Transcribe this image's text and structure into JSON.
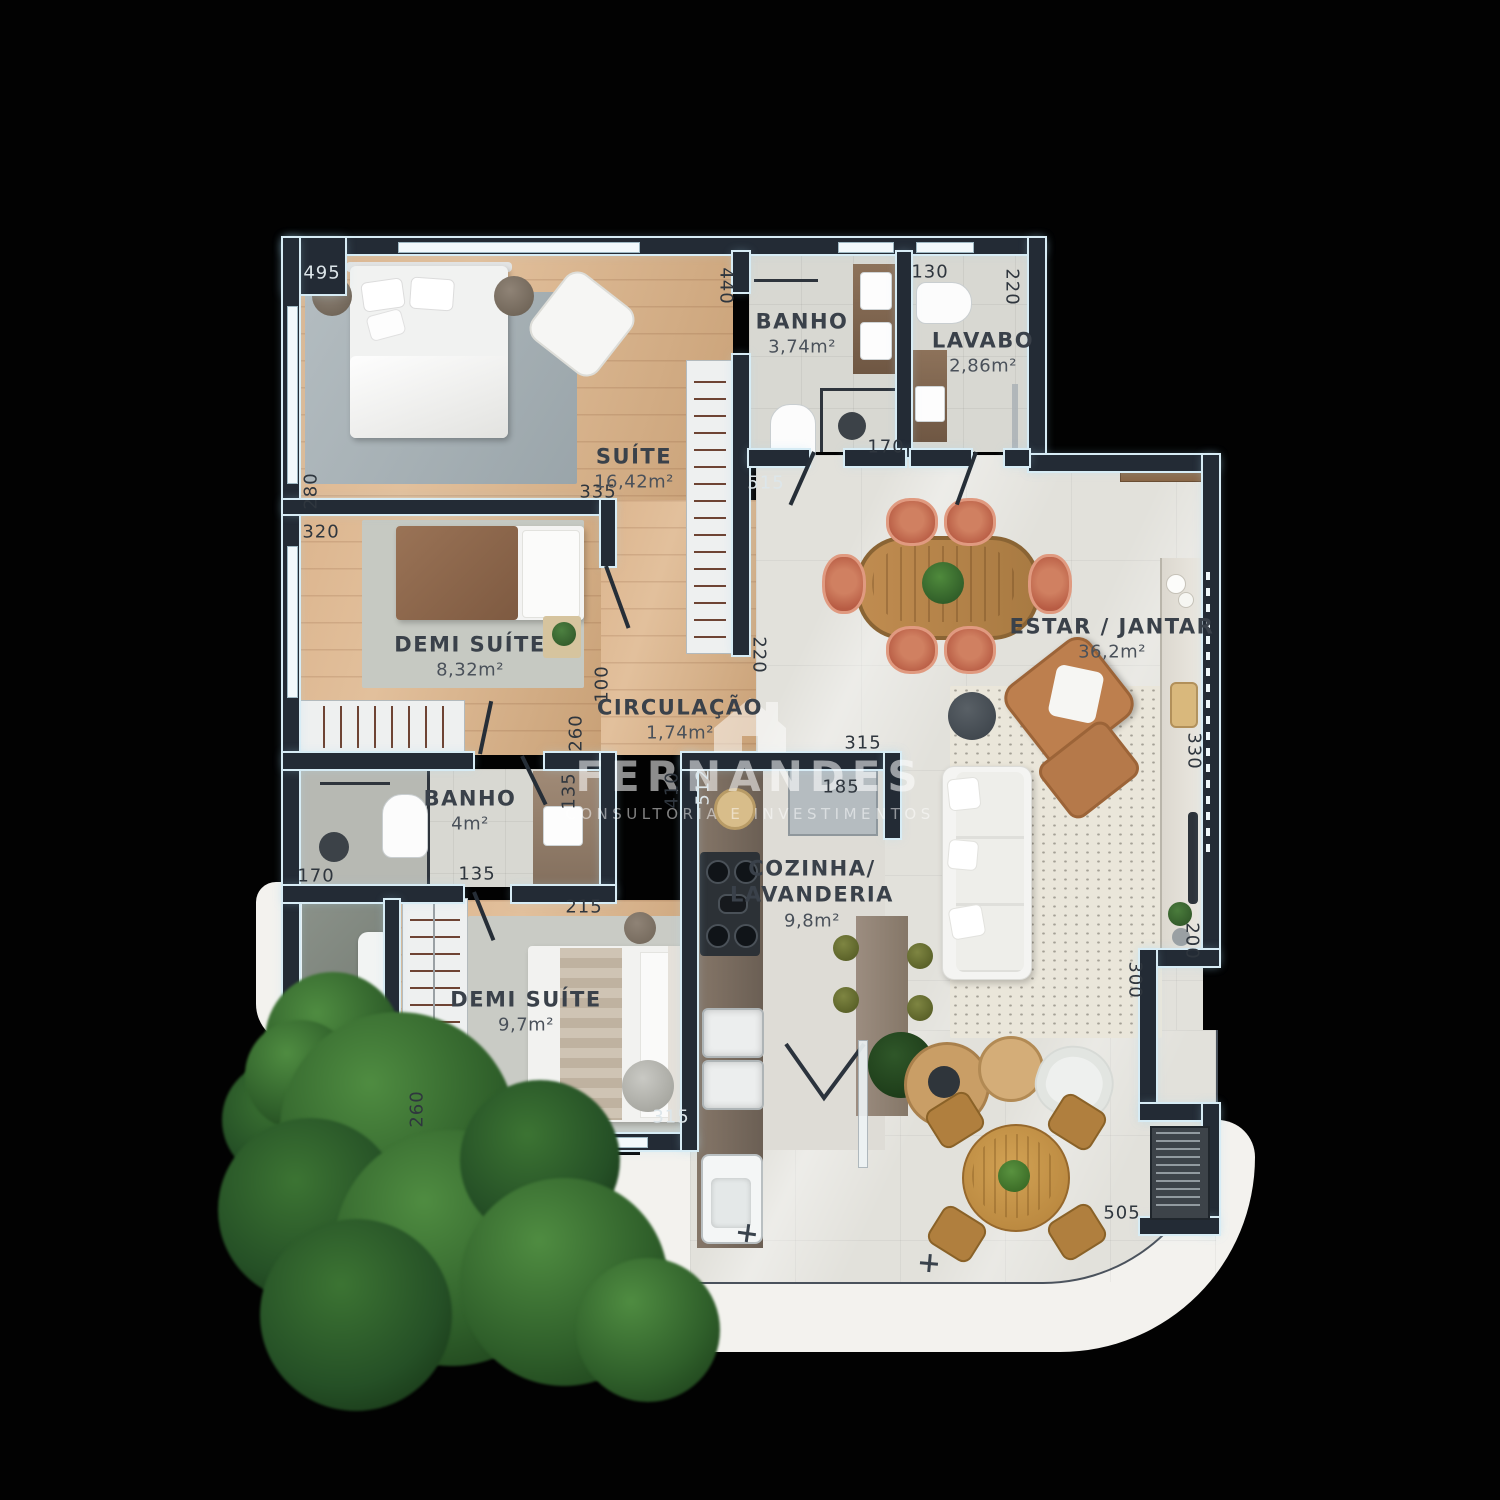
{
  "watermark": {
    "brand": "FERNANDES",
    "tagline": "CONSULTORIA E INVESTIMENTOS"
  },
  "rooms": [
    {
      "name": "SUÍTE",
      "area": "16,42m²",
      "x": 634,
      "y": 468
    },
    {
      "name": "DEMI SUÍTE",
      "area": "8,32m²",
      "x": 470,
      "y": 656
    },
    {
      "name": "BANHO",
      "area": "3,74m²",
      "x": 802,
      "y": 333
    },
    {
      "name": "LAVABO",
      "area": "2,86m²",
      "x": 983,
      "y": 352
    },
    {
      "name": "ESTAR / JANTAR",
      "area": "36,2m²",
      "x": 1112,
      "y": 638
    },
    {
      "name": "CIRCULAÇÃO",
      "area": "1,74m²",
      "x": 680,
      "y": 719
    },
    {
      "name": "BANHO",
      "area": "4m²",
      "x": 470,
      "y": 810
    },
    {
      "name": "COZINHA/\nLAVANDERIA",
      "area": "9,8m²",
      "x": 812,
      "y": 893
    },
    {
      "name": "DEMI SUÍTE",
      "area": "9,7m²",
      "x": 526,
      "y": 1011
    }
  ],
  "dimensions": [
    {
      "label": "495",
      "x": 322,
      "y": 273,
      "rot": 0,
      "light": true
    },
    {
      "label": "440",
      "x": 726,
      "y": 286,
      "rot": 90,
      "light": false
    },
    {
      "label": "130",
      "x": 930,
      "y": 272,
      "rot": 0,
      "light": false
    },
    {
      "label": "220",
      "x": 1012,
      "y": 287,
      "rot": 90,
      "light": false
    },
    {
      "label": "280",
      "x": 311,
      "y": 491,
      "rot": -90,
      "light": false
    },
    {
      "label": "335",
      "x": 598,
      "y": 492,
      "rot": 0,
      "light": false
    },
    {
      "label": "320",
      "x": 321,
      "y": 532,
      "rot": 0,
      "light": false
    },
    {
      "label": "515",
      "x": 766,
      "y": 483,
      "rot": 0,
      "light": true
    },
    {
      "label": "170",
      "x": 886,
      "y": 447,
      "rot": 0,
      "light": false
    },
    {
      "label": "220",
      "x": 759,
      "y": 655,
      "rot": 90,
      "light": false
    },
    {
      "label": "100",
      "x": 602,
      "y": 684,
      "rot": -90,
      "light": false
    },
    {
      "label": "260",
      "x": 576,
      "y": 733,
      "rot": -90,
      "light": false
    },
    {
      "label": "315",
      "x": 863,
      "y": 743,
      "rot": 0,
      "light": false
    },
    {
      "label": "512",
      "x": 703,
      "y": 787,
      "rot": -90,
      "light": true
    },
    {
      "label": "410",
      "x": 672,
      "y": 790,
      "rot": -90,
      "light": false
    },
    {
      "label": "185",
      "x": 841,
      "y": 787,
      "rot": 0,
      "light": false
    },
    {
      "label": "135",
      "x": 569,
      "y": 791,
      "rot": -90,
      "light": false
    },
    {
      "label": "170",
      "x": 316,
      "y": 876,
      "rot": 0,
      "light": false
    },
    {
      "label": "135",
      "x": 477,
      "y": 874,
      "rot": 0,
      "light": false
    },
    {
      "label": "215",
      "x": 584,
      "y": 907,
      "rot": 0,
      "light": false
    },
    {
      "label": "260",
      "x": 417,
      "y": 1109,
      "rot": -90,
      "light": false
    },
    {
      "label": "315",
      "x": 671,
      "y": 1117,
      "rot": 0,
      "light": true
    },
    {
      "label": "330",
      "x": 1194,
      "y": 751,
      "rot": 90,
      "light": false
    },
    {
      "label": "200",
      "x": 1192,
      "y": 941,
      "rot": 90,
      "light": false
    },
    {
      "label": "300",
      "x": 1135,
      "y": 980,
      "rot": 90,
      "light": false
    },
    {
      "label": "505",
      "x": 1122,
      "y": 1213,
      "rot": 0,
      "light": false
    }
  ],
  "palette": {
    "wall": "#232b35",
    "wall_edge": "#d7ecf5",
    "wood": "#dcb58e",
    "wood_deep": "#c9a177",
    "tile": "#e2e1db",
    "tile_bath": "#d8d8d2",
    "counter": "#7b6d61",
    "accent_chair": "#c2654d",
    "leather": "#bd7f4e",
    "olive_stool": "#6d7434",
    "tree": "#2f5f2a",
    "slab": "#f3f2ee",
    "label": "#2f363e",
    "label_light": "#dde6ea"
  }
}
